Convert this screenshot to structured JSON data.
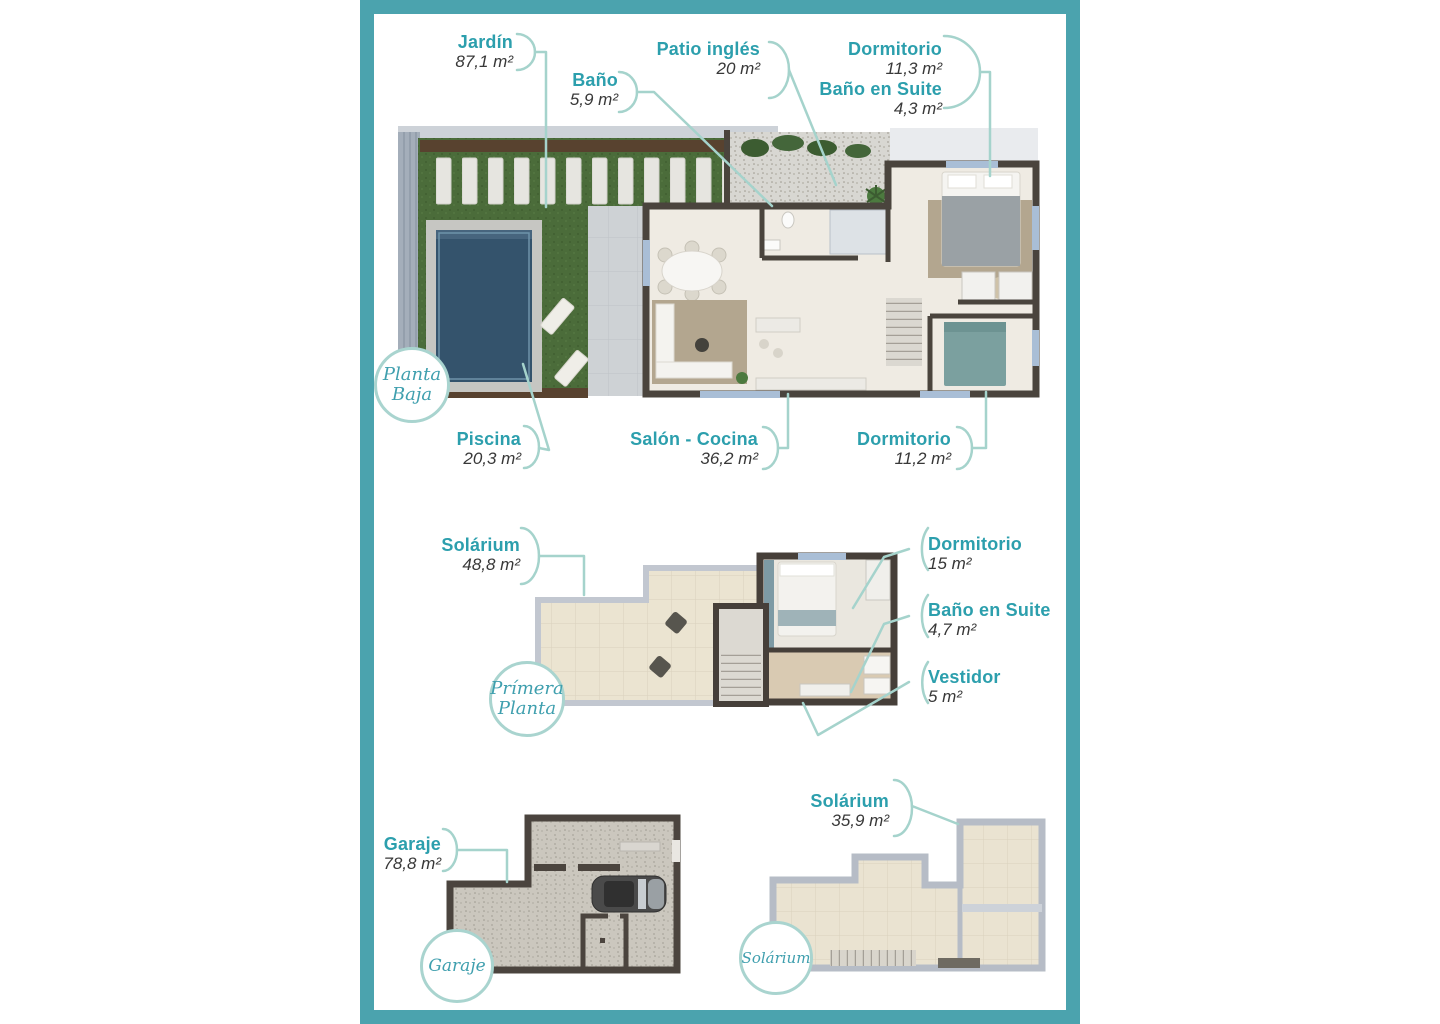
{
  "colors": {
    "frame_teal": "#4ba3ae",
    "label_teal": "#2c9fad",
    "value_dark": "#383838",
    "leader_line": "#a5d3cc",
    "badge_ring": "#a9d4cf",
    "wall_dark": "#4a443d",
    "grass_green": "#4b6c3a",
    "pool_blue": "#34536c",
    "tile_cream": "#ebe4d0"
  },
  "floors": [
    {
      "id": "planta-baja",
      "badge_lines": [
        "Planta",
        "Baja"
      ],
      "rooms": [
        {
          "name": "Jardín",
          "area": "87,1 m²"
        },
        {
          "name": "Baño",
          "area": "5,9 m²"
        },
        {
          "name": "Patio inglés",
          "area": "20 m²"
        },
        {
          "name": "Dormitorio",
          "area": "11,3 m²"
        },
        {
          "name": "Baño en Suite",
          "area": "4,3 m²"
        },
        {
          "name": "Piscina",
          "area": "20,3 m²"
        },
        {
          "name": "Salón - Cocina",
          "area": "36,2 m²"
        },
        {
          "name": "Dormitorio",
          "area": "11,2 m²"
        }
      ]
    },
    {
      "id": "primera-planta",
      "badge_lines": [
        "Prímera",
        "Planta"
      ],
      "rooms": [
        {
          "name": "Solárium",
          "area": "48,8 m²"
        },
        {
          "name": "Dormitorio",
          "area": "15 m²"
        },
        {
          "name": "Baño en Suite",
          "area": "4,7 m²"
        },
        {
          "name": "Vestidor",
          "area": "5 m²"
        }
      ]
    },
    {
      "id": "garaje",
      "badge_lines": [
        "Garaje"
      ],
      "rooms": [
        {
          "name": "Garaje",
          "area": "78,8 m²"
        }
      ]
    },
    {
      "id": "solarium",
      "badge_lines": [
        "Solárium"
      ],
      "rooms": [
        {
          "name": "Solárium",
          "area": "35,9 m²"
        }
      ]
    }
  ]
}
